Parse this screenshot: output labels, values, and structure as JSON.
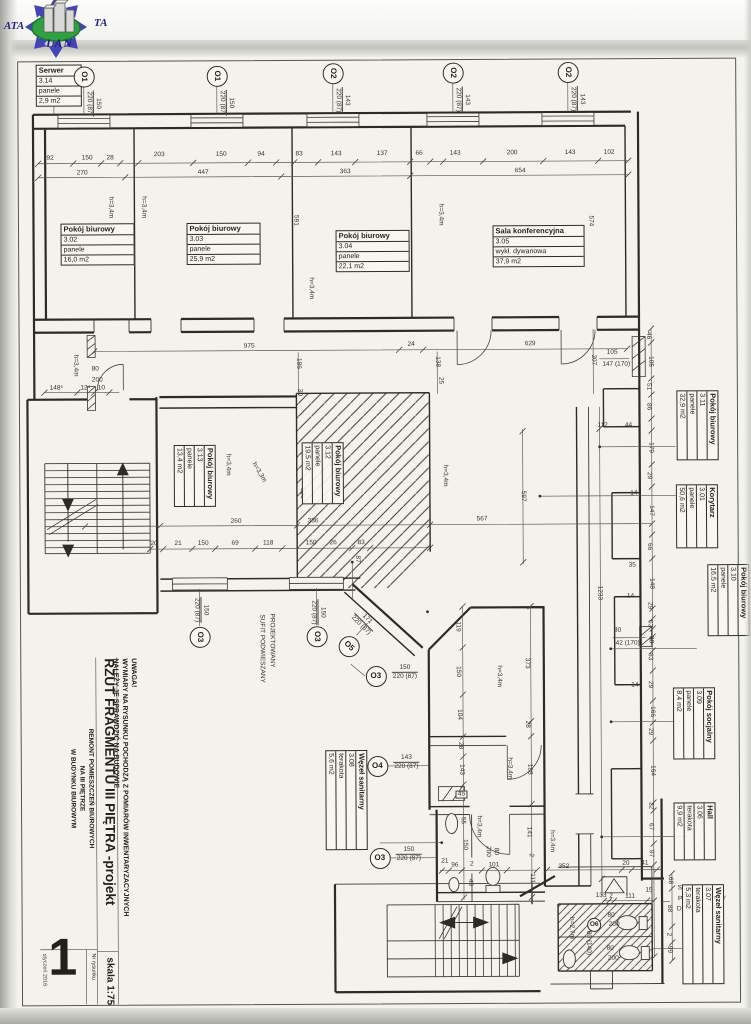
{
  "logo": {
    "ata": "ATA",
    "ta": "TA",
    "lan": "LAN"
  },
  "title_block": {
    "note1": "UWAGA!",
    "note2": "WYMIARY NA RYSUNKU POCHODZĄ Z POMIARÓW INWENTARYZACYJNYCH",
    "note3": "NALEŻY JE SPRAWDZIĆ NA BUDOWIE",
    "title": "RZUT FRAGMENTU III PIĘTRA -projekt",
    "project1": "REMONT POMIESZCZEŃ BIUROWYCH",
    "project2": "NA III PIĘTRZE",
    "project3": "W BUDYNKU BIUROWYM",
    "scale": "skala 1:75",
    "drawing_no_label": "Nr rysunku",
    "drawing_no": "1",
    "date": "styczeń 2016"
  },
  "rooms": [
    {
      "name": "Serwer",
      "num": "3.14",
      "floor": "panele",
      "area": "2,9 m2",
      "x": 38,
      "y": 63,
      "w": 46,
      "r": 0
    },
    {
      "name": "Pokój biurowy",
      "num": "3.02",
      "floor": "panele",
      "area": "16,0 m2",
      "x": 62,
      "y": 222,
      "w": 74,
      "r": 0
    },
    {
      "name": "Pokój biurowy",
      "num": "3.03",
      "floor": "panele",
      "area": "25,9 m2",
      "x": 188,
      "y": 222,
      "w": 74,
      "r": 0
    },
    {
      "name": "Pokój biurowy",
      "num": "3.04",
      "floor": "panele",
      "area": "22,1 m2",
      "x": 337,
      "y": 230,
      "w": 74,
      "r": 0
    },
    {
      "name": "Sala konferencyjna",
      "num": "3.05",
      "floor": "wykł. dywanowa",
      "area": "37,9 m2",
      "x": 494,
      "y": 226,
      "w": 92,
      "r": 0
    },
    {
      "name": "Pokój biurowy",
      "num": "3.13",
      "floor": "panele",
      "area": "13,4 m2",
      "x": 216,
      "y": 444,
      "w": 62,
      "r": 90
    },
    {
      "name": "Pokój biurowy",
      "num": "3.12",
      "floor": "panele",
      "area": "19,5 m2",
      "x": 344,
      "y": 442,
      "w": 62,
      "r": 90
    },
    {
      "name": "Pokój biurowy",
      "num": "3.11",
      "floor": "panele",
      "area": "32,9 m2",
      "x": 719,
      "y": 392,
      "w": 70,
      "r": 90
    },
    {
      "name": "Korytarz",
      "num": "3.01",
      "floor": "panele",
      "area": "50,6 m2",
      "x": 718,
      "y": 486,
      "w": 64,
      "r": 90
    },
    {
      "name": "Pokój biurowy",
      "num": "3.10",
      "floor": "panele",
      "area": "16,5 m2",
      "x": 749,
      "y": 566,
      "w": 72,
      "r": 90
    },
    {
      "name": "Pokój socjalny",
      "num": "3.09",
      "floor": "panele",
      "area": "8,4 m2",
      "x": 714,
      "y": 689,
      "w": 72,
      "r": 90
    },
    {
      "name": "Hall",
      "num": "3.06",
      "floor": "terakota",
      "area": "9,9 m2",
      "x": 714,
      "y": 804,
      "w": 58,
      "r": 90
    },
    {
      "name": "Węzeł sanitarny",
      "num": "3.07",
      "floor": "terakota",
      "area": "5,3 m2",
      "x": 722,
      "y": 886,
      "w": 100,
      "r": 90
    },
    {
      "name": "Węzeł sanitarny",
      "num": "3.08",
      "floor": "terakota",
      "area": "5,6 m2",
      "x": 366,
      "y": 750,
      "w": 100,
      "r": 90
    }
  ],
  "openings": [
    {
      "id": "O1",
      "x": 86,
      "y": 75,
      "ir": 90,
      "top": "150",
      "bot": "220 (87)",
      "fx": 104,
      "fy": 89,
      "fr": 90
    },
    {
      "id": "O1",
      "x": 219,
      "y": 75,
      "ir": 90,
      "top": "150",
      "bot": "220 (87)",
      "fx": 237,
      "fy": 89,
      "fr": 90
    },
    {
      "id": "O2",
      "x": 335,
      "y": 73,
      "ir": 90,
      "top": "143",
      "bot": "220 (87)",
      "fx": 353,
      "fy": 87,
      "fr": 90
    },
    {
      "id": "O2",
      "x": 455,
      "y": 73,
      "ir": 90,
      "top": "143",
      "bot": "220 (87)",
      "fx": 473,
      "fy": 87,
      "fr": 90
    },
    {
      "id": "O2",
      "x": 570,
      "y": 73,
      "ir": 90,
      "top": "143",
      "bot": "220 (87)",
      "fx": 588,
      "fy": 87,
      "fr": 90
    },
    {
      "id": "O3",
      "x": 199,
      "y": 636,
      "ir": 90,
      "top": "150",
      "bot": "220 (87)",
      "fx": 209,
      "fy": 596,
      "fr": 90
    },
    {
      "id": "O3",
      "x": 316,
      "y": 636,
      "ir": 90,
      "top": "150",
      "bot": "220 (87)",
      "fx": 326,
      "fy": 599,
      "fr": 90
    },
    {
      "id": "O5",
      "x": 348,
      "y": 646,
      "ir": 45,
      "top": "171",
      "bot": "220 (87)",
      "fx": 360,
      "fy": 607,
      "fr": 45
    },
    {
      "id": "O3",
      "x": 375,
      "y": 676,
      "ir": 0,
      "top": "150",
      "bot": "220 (87)",
      "fx": 391,
      "fy": 664,
      "fr": 0
    },
    {
      "id": "O4",
      "x": 376,
      "y": 766,
      "ir": 0,
      "top": "143",
      "bot": "220 (87)",
      "fx": 392,
      "fy": 754,
      "fr": 0
    },
    {
      "id": "O3",
      "x": 378,
      "y": 858,
      "ir": 0,
      "top": "150",
      "bot": "220 (87)",
      "fx": 394,
      "fy": 846,
      "fr": 0
    },
    {
      "id": "O6",
      "x": 592,
      "y": 926,
      "ir": 0,
      "small": 1
    }
  ],
  "dims": [
    {
      "t": "92",
      "x": 52,
      "y": 157
    },
    {
      "t": "150",
      "x": 89,
      "y": 157
    },
    {
      "t": "28",
      "x": 112,
      "y": 157
    },
    {
      "t": "270",
      "x": 84,
      "y": 172
    },
    {
      "t": "203",
      "x": 161,
      "y": 154
    },
    {
      "t": "150",
      "x": 223,
      "y": 154
    },
    {
      "t": "94",
      "x": 263,
      "y": 154
    },
    {
      "t": "447",
      "x": 205,
      "y": 172
    },
    {
      "t": "83",
      "x": 301,
      "y": 154
    },
    {
      "t": "143",
      "x": 338,
      "y": 154
    },
    {
      "t": "137",
      "x": 384,
      "y": 154
    },
    {
      "t": "363",
      "x": 347,
      "y": 172
    },
    {
      "t": "66",
      "x": 421,
      "y": 154
    },
    {
      "t": "143",
      "x": 457,
      "y": 154
    },
    {
      "t": "200",
      "x": 514,
      "y": 154
    },
    {
      "t": "143",
      "x": 572,
      "y": 154
    },
    {
      "t": "102",
      "x": 611,
      "y": 154
    },
    {
      "t": "654",
      "x": 522,
      "y": 172
    },
    {
      "t": "591",
      "x": 297,
      "y": 220,
      "r": 90
    },
    {
      "t": "574",
      "x": 592,
      "y": 222,
      "r": 90
    },
    {
      "t": "h=3,4m",
      "x": 112,
      "y": 206,
      "r": 90
    },
    {
      "t": "h=3,4m",
      "x": 145,
      "y": 206,
      "r": 90
    },
    {
      "t": "h=3,4m",
      "x": 312,
      "y": 288,
      "r": 90
    },
    {
      "t": "h=3,4m",
      "x": 442,
      "y": 215,
      "r": 90
    },
    {
      "t": "975",
      "x": 250,
      "y": 346
    },
    {
      "t": "186",
      "x": 299,
      "y": 363,
      "r": 90
    },
    {
      "t": "30",
      "x": 300,
      "y": 392,
      "r": 90
    },
    {
      "t": "24",
      "x": 412,
      "y": 345
    },
    {
      "t": "629",
      "x": 531,
      "y": 345
    },
    {
      "t": "138",
      "x": 438,
      "y": 362,
      "r": 90
    },
    {
      "t": "25",
      "x": 441,
      "y": 381,
      "r": 90
    },
    {
      "t": "207",
      "x": 594,
      "y": 361,
      "r": 90
    },
    {
      "t": "105",
      "x": 613,
      "y": 354
    },
    {
      "t": "147 (170)",
      "x": 617,
      "y": 366
    },
    {
      "t": "148⁵",
      "x": 57,
      "y": 387
    },
    {
      "t": "12⁴",
      "x": 86,
      "y": 387
    },
    {
      "t": "10",
      "x": 102,
      "y": 387
    },
    {
      "t": "80",
      "x": 96,
      "y": 368
    },
    {
      "t": "200",
      "x": 98,
      "y": 379
    },
    {
      "t": "h=3,4m",
      "x": 76,
      "y": 364,
      "r": 90
    },
    {
      "t": "46",
      "x": 649,
      "y": 337,
      "r": 90
    },
    {
      "t": "105",
      "x": 651,
      "y": 363,
      "r": 90
    },
    {
      "t": "51",
      "x": 649,
      "y": 388,
      "r": 90
    },
    {
      "t": "86",
      "x": 649,
      "y": 408,
      "r": 90
    },
    {
      "t": "179",
      "x": 651,
      "y": 449,
      "r": 90
    },
    {
      "t": "29",
      "x": 649,
      "y": 477,
      "r": 90
    },
    {
      "t": "147",
      "x": 651,
      "y": 512,
      "r": 90
    },
    {
      "t": "66",
      "x": 649,
      "y": 548,
      "r": 90
    },
    {
      "t": "148",
      "x": 651,
      "y": 585,
      "r": 90
    },
    {
      "t": "29",
      "x": 649,
      "y": 607,
      "r": 90
    },
    {
      "t": "53",
      "x": 649,
      "y": 625,
      "r": 90
    },
    {
      "t": "30",
      "x": 650,
      "y": 641,
      "r": 90
    },
    {
      "t": "83",
      "x": 649,
      "y": 658,
      "r": 90
    },
    {
      "t": "29",
      "x": 649,
      "y": 686,
      "r": 90
    },
    {
      "t": "166",
      "x": 651,
      "y": 713,
      "r": 90
    },
    {
      "t": "29",
      "x": 649,
      "y": 733,
      "r": 90
    },
    {
      "t": "164",
      "x": 651,
      "y": 772,
      "r": 90
    },
    {
      "t": "22",
      "x": 649,
      "y": 807,
      "r": 90
    },
    {
      "t": "67",
      "x": 649,
      "y": 828,
      "r": 90
    },
    {
      "t": "97",
      "x": 649,
      "y": 855,
      "r": 90
    },
    {
      "t": "68",
      "x": 668,
      "y": 882,
      "r": 90
    },
    {
      "t": "88",
      "x": 667,
      "y": 910,
      "r": 90
    },
    {
      "t": "2",
      "x": 666,
      "y": 936,
      "r": 90
    },
    {
      "t": "99",
      "x": 667,
      "y": 951,
      "r": 90
    },
    {
      "t": "112",
      "x": 603,
      "y": 427
    },
    {
      "t": "44",
      "x": 629,
      "y": 427
    },
    {
      "t": "14",
      "x": 634,
      "y": 495
    },
    {
      "t": "35",
      "x": 632,
      "y": 567
    },
    {
      "t": "14",
      "x": 630,
      "y": 598
    },
    {
      "t": "14",
      "x": 634,
      "y": 687
    },
    {
      "t": "30",
      "x": 617,
      "y": 632
    },
    {
      "t": "42 (170)",
      "x": 627,
      "y": 645
    },
    {
      "t": "20",
      "x": 624,
      "y": 865
    },
    {
      "t": "41",
      "x": 643,
      "y": 865
    },
    {
      "t": "567",
      "x": 482,
      "y": 520
    },
    {
      "t": "597",
      "x": 523,
      "y": 497,
      "r": 90
    },
    {
      "t": "1233",
      "x": 599,
      "y": 594,
      "r": 90
    },
    {
      "t": "h=3,4m",
      "x": 445,
      "y": 476,
      "r": 90
    },
    {
      "t": "260",
      "x": 236,
      "y": 521
    },
    {
      "t": "386",
      "x": 313,
      "y": 521
    },
    {
      "t": "20",
      "x": 154,
      "y": 543
    },
    {
      "t": "21",
      "x": 178,
      "y": 543
    },
    {
      "t": "150",
      "x": 203,
      "y": 543
    },
    {
      "t": "69",
      "x": 235,
      "y": 543
    },
    {
      "t": "118",
      "x": 268,
      "y": 543
    },
    {
      "t": "150",
      "x": 311,
      "y": 543
    },
    {
      "t": "26",
      "x": 333,
      "y": 543
    },
    {
      "t": "83",
      "x": 361,
      "y": 543
    },
    {
      "t": "520",
      "x": 302,
      "y": 493,
      "r": 90
    },
    {
      "t": "87",
      "x": 357,
      "y": 559,
      "r": 90
    },
    {
      "t": "h=3,4m",
      "x": 228,
      "y": 464,
      "r": 90
    },
    {
      "t": "h=3,3m",
      "x": 259,
      "y": 472,
      "r": 60
    },
    {
      "t": "119",
      "x": 457,
      "y": 627,
      "r": 90
    },
    {
      "t": "150",
      "x": 457,
      "y": 672,
      "r": 90
    },
    {
      "t": "104",
      "x": 458,
      "y": 715,
      "r": 90
    },
    {
      "t": "373",
      "x": 526,
      "y": 664,
      "r": 90
    },
    {
      "t": "28",
      "x": 526,
      "y": 725,
      "r": 90
    },
    {
      "t": "28",
      "x": 459,
      "y": 746,
      "r": 90
    },
    {
      "t": "143",
      "x": 460,
      "y": 770,
      "r": 90
    },
    {
      "t": "188",
      "x": 528,
      "y": 770,
      "r": 90
    },
    {
      "t": "h=3,4m",
      "x": 498,
      "y": 677,
      "r": 90
    },
    {
      "t": "h=3,4m",
      "x": 508,
      "y": 769,
      "r": 90
    },
    {
      "t": "45",
      "x": 460,
      "y": 795,
      "b": 1
    },
    {
      "t": "21",
      "x": 443,
      "y": 862
    },
    {
      "t": "96",
      "x": 453,
      "y": 866
    },
    {
      "t": "2",
      "x": 470,
      "y": 865
    },
    {
      "t": "101",
      "x": 492,
      "y": 866
    },
    {
      "t": "150",
      "x": 463,
      "y": 845,
      "r": 90
    },
    {
      "t": "55",
      "x": 461,
      "y": 821,
      "r": 90
    },
    {
      "t": "h=3,4m",
      "x": 477,
      "y": 827,
      "r": 90
    },
    {
      "t": "80",
      "x": 494,
      "y": 852,
      "r": 90
    },
    {
      "t": "200",
      "x": 486,
      "y": 852,
      "r": 90
    },
    {
      "t": "49",
      "x": 468,
      "y": 883,
      "r": 90
    },
    {
      "t": "141",
      "x": 527,
      "y": 833,
      "r": 90
    },
    {
      "t": "2",
      "x": 529,
      "y": 856,
      "r": 90
    },
    {
      "t": "111",
      "x": 530,
      "y": 879,
      "r": 90
    },
    {
      "t": "h=3,4m",
      "x": 550,
      "y": 842,
      "r": 90
    },
    {
      "t": "352",
      "x": 562,
      "y": 868
    },
    {
      "t": "133",
      "x": 599,
      "y": 897
    },
    {
      "t": "2",
      "x": 609,
      "y": 898
    },
    {
      "t": "111",
      "x": 628,
      "y": 898
    },
    {
      "t": "15",
      "x": 647,
      "y": 892
    },
    {
      "t": "80",
      "x": 609,
      "y": 917
    },
    {
      "t": "200",
      "x": 612,
      "y": 926
    },
    {
      "t": "80",
      "x": 608,
      "y": 950
    },
    {
      "t": "200",
      "x": 611,
      "y": 960
    },
    {
      "t": "80 (140)",
      "x": 586,
      "y": 944,
      "r": 90
    },
    {
      "t": "h=2,7m",
      "x": 569,
      "y": 929,
      "r": 90
    },
    {
      "t": "PROJEKTOWANY",
      "x": 271,
      "y": 640,
      "r": 90
    },
    {
      "t": "SUFIT PODWIESZANY",
      "x": 261,
      "y": 648,
      "r": 90
    },
    {
      "t": "SUFIT",
      "x": 685,
      "y": 890
    },
    {
      "t": "PODWIESZANY",
      "x": 700,
      "y": 901
    },
    {
      "t": "DO REMONTU",
      "x": 697,
      "y": 911
    }
  ]
}
